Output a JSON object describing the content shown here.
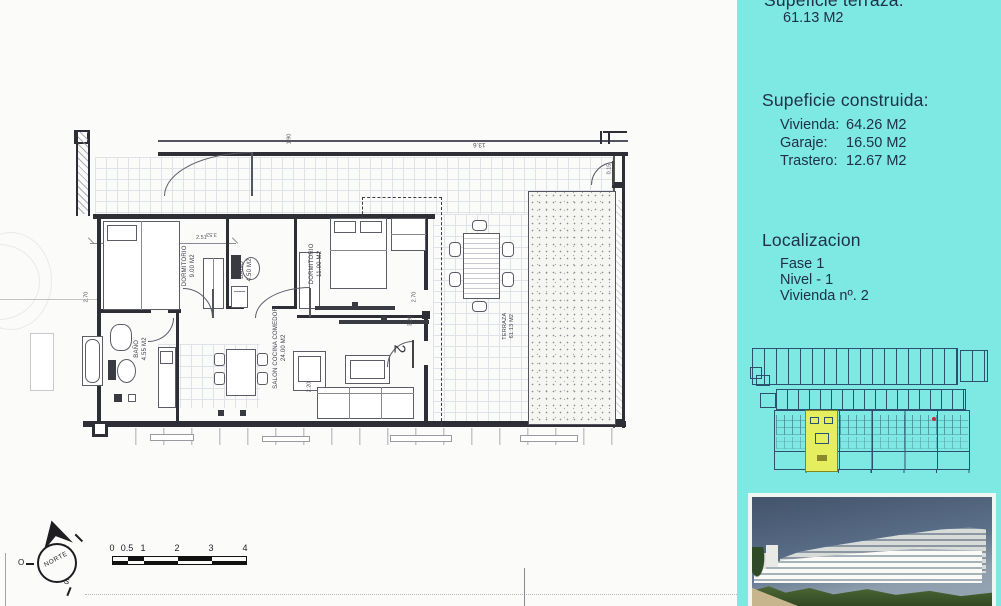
{
  "panel": {
    "bg": "#7de9e2",
    "text_color": "#20304a",
    "terraza": {
      "heading": "Supeficie terraza:",
      "value": "61.13 M2"
    },
    "construida": {
      "heading": "Supeficie construida:",
      "items": [
        {
          "label": "Vivienda:",
          "value": "64.26 M2"
        },
        {
          "label": "Garaje:",
          "value": "16.50 M2"
        },
        {
          "label": "Trastero:",
          "value": "12.67 M2"
        }
      ]
    },
    "localizacion": {
      "heading": "Localizacion",
      "items": [
        "Fase 1",
        "Nivel - 1",
        "Vivienda nº. 2"
      ]
    }
  },
  "plan": {
    "rooms": [
      {
        "name": "DORMITORIO",
        "area": "9.00 M2"
      },
      {
        "name": "BAÑO",
        "area": "4.50 M2"
      },
      {
        "name": "DORMITORIO",
        "area": "11.00 M2"
      },
      {
        "name": "BAÑO",
        "area": "4.55 M2"
      },
      {
        "name": "SALON COCINA COMEDOR",
        "area": "24.00 M2"
      },
      {
        "name": "TERRAZA",
        "area": "61.13 M2"
      }
    ],
    "unit_number": "2",
    "dims": {
      "d251": "2.51",
      "d190": "1.90",
      "d136": "13.6",
      "d015": "0.15",
      "d270": "2.70",
      "d320": "3.20",
      "d220": "2.20",
      "d353": "3.53"
    }
  },
  "compass": {
    "label": "NORTE",
    "west": "O",
    "south": "S"
  },
  "scalebar": {
    "ticks": [
      "0",
      "0.5",
      "1",
      "2",
      "3",
      "4"
    ]
  },
  "colors": {
    "highlight_unit": "#e4ee5e",
    "siteplan_line": "#2d4f70",
    "panel_bg": "#7de9e2"
  }
}
